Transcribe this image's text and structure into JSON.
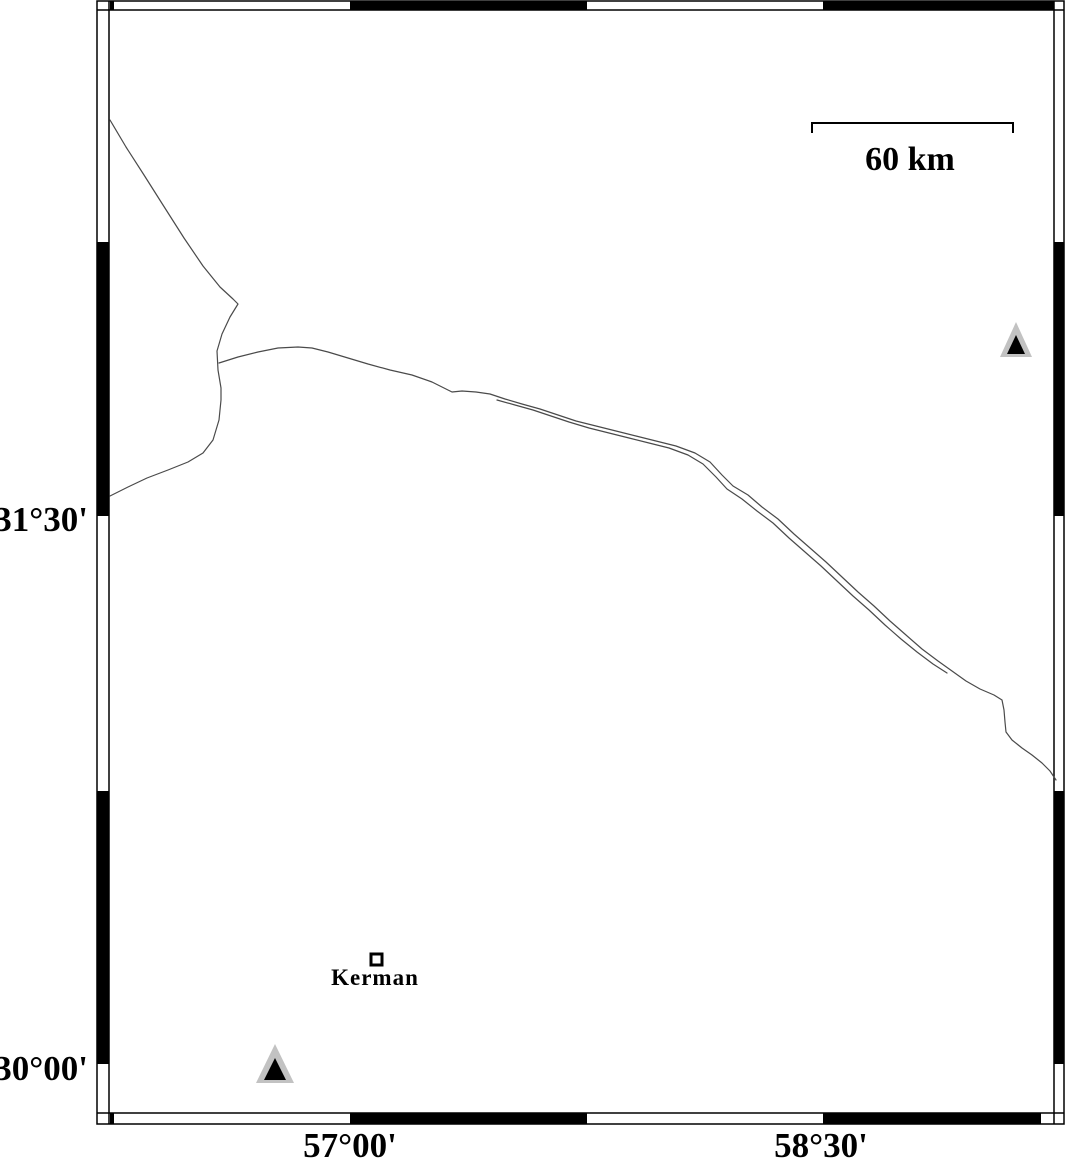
{
  "map": {
    "scale_bar": {
      "label": "60 km"
    },
    "latitude_labels": {
      "upper": "31°30'",
      "lower": "30°00'"
    },
    "longitude_labels": {
      "left": "57°00'",
      "right": "58°30'"
    },
    "city": {
      "name": "Kerman"
    }
  },
  "colors": {
    "frame": "#000000",
    "coast_line": "#4a4a4a",
    "station_triangle_fill": "#c2c2c2",
    "station_triangle_core": "#000000",
    "background": "#ffffff"
  },
  "icons": {
    "station_marker": "filled-triangle-station-icon",
    "city_marker": "open-square-city-icon"
  }
}
